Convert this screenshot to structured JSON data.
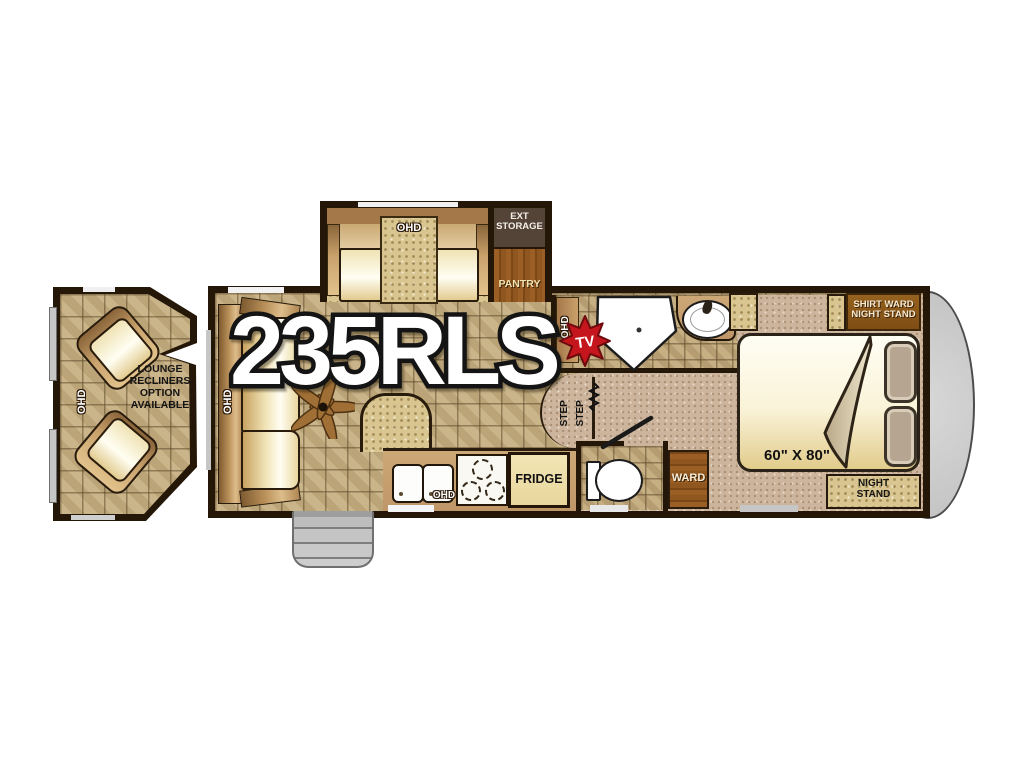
{
  "title": {
    "model": "235RLS",
    "tv_badge": "TV"
  },
  "option_module": {
    "ohd": "OHD",
    "line1": "LOUNGE",
    "line2": "RECLINERS",
    "line3": "OPTION",
    "line4": "AVAILABLE"
  },
  "slideout": {
    "ohd": "OHD",
    "ext_storage_line1": "EXT",
    "ext_storage_line2": "STORAGE",
    "pantry": "PANTRY"
  },
  "living": {
    "sofa_ohd": "OHD"
  },
  "kitchen": {
    "ohd": "OHD",
    "fridge": "FRIDGE"
  },
  "bath": {
    "ohd": "OHD"
  },
  "steps": {
    "step1": "STEP",
    "step2": "STEP"
  },
  "bedroom": {
    "shirt_ward_line1": "SHIRT WARD",
    "shirt_ward_line2": "NIGHT STAND",
    "bed_size": "60\" X 80\"",
    "night_stand_line1": "NIGHT",
    "night_stand_line2": "STAND",
    "ward": "WARD"
  },
  "colors": {
    "accent_red": "#c4161c",
    "wall": "#241708",
    "tile": "#c6ae80",
    "carpet": "#ccb59c",
    "wood": "#8f571f",
    "cream": "#f6edc9",
    "front_cap": "#cecece"
  }
}
